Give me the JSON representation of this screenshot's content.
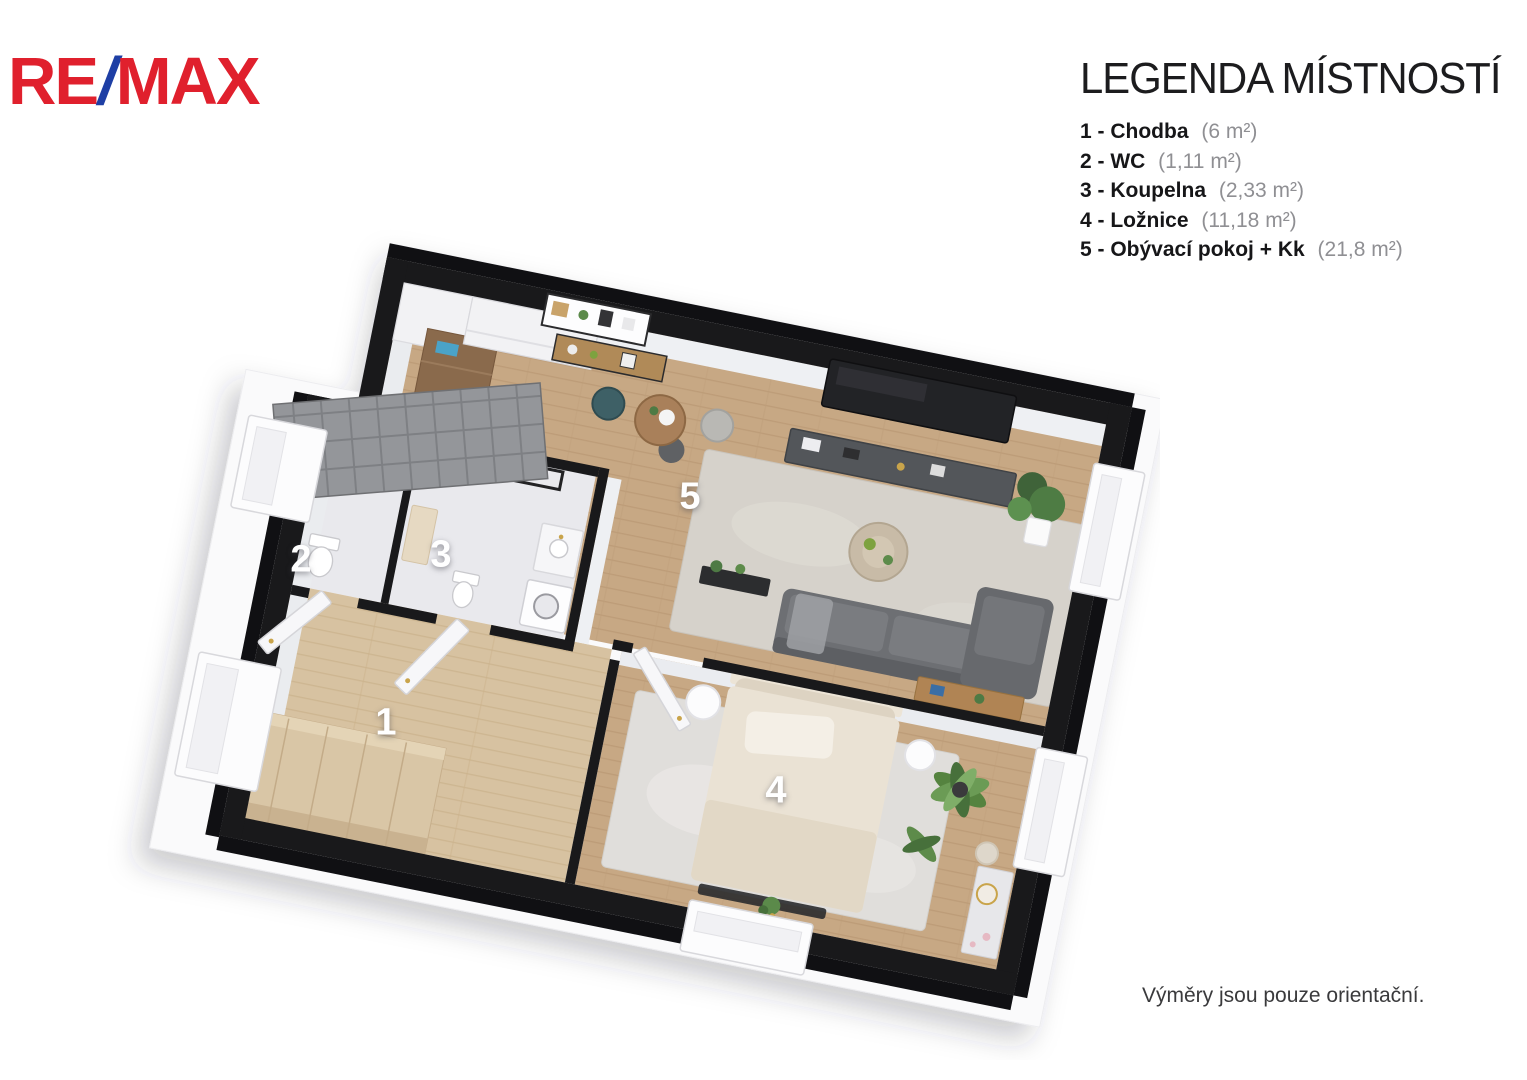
{
  "logo": {
    "text_re": "RE",
    "text_slash": "/",
    "text_max": "MAX",
    "red_hex": "#e0202d",
    "blue_hex": "#1e3fa5"
  },
  "legend": {
    "title": "LEGENDA MÍSTNOSTÍ",
    "items": [
      {
        "label": "1 - Chodba",
        "area": "(6 m²)"
      },
      {
        "label": "2 - WC",
        "area": "(1,11 m²)"
      },
      {
        "label": "3 - Koupelna",
        "area": "(2,33 m²)"
      },
      {
        "label": "4 - Ložnice",
        "area": "(11,18 m²)"
      },
      {
        "label": "5 - Obývací pokoj + Kk",
        "area": "(21,8 m²)"
      }
    ]
  },
  "floor_plan": {
    "room_labels": [
      {
        "number": "1",
        "room": "Chodba"
      },
      {
        "number": "2",
        "room": "WC"
      },
      {
        "number": "3",
        "room": "Koupelna"
      },
      {
        "number": "4",
        "room": "Ložnice"
      },
      {
        "number": "5",
        "room": "Obývací pokoj + Kk"
      }
    ]
  },
  "footer": {
    "disclaimer": "Výměry jsou pouze orientační."
  }
}
